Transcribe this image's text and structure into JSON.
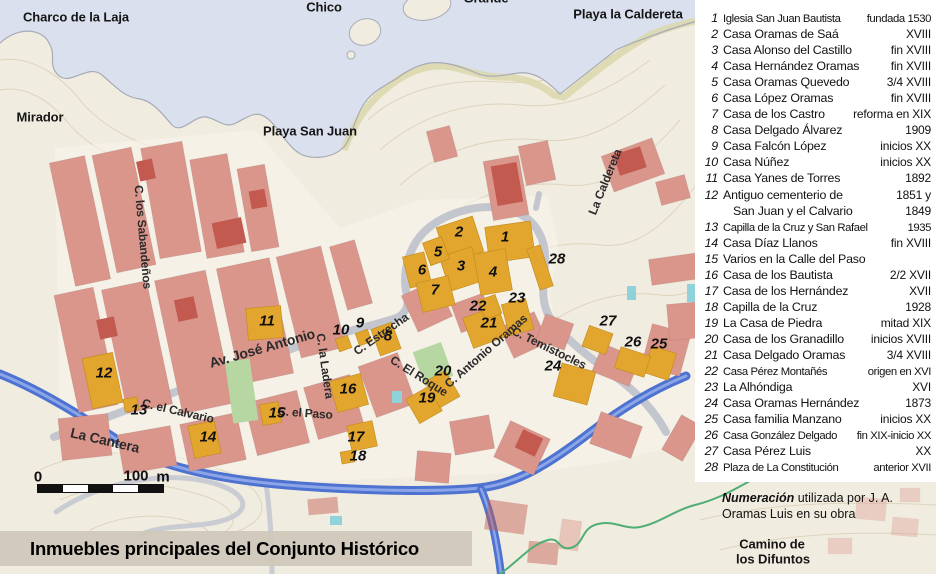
{
  "title": {
    "text": "Inmuebles principales del Conjunto Histórico"
  },
  "colors": {
    "land": "#f1ece0",
    "town": "#f8f5ed",
    "water": "#dbe0ee",
    "coastline": "#a7abb5",
    "beach": "#dbd8ab",
    "contour": "#dcd2b8",
    "roadgray": "#c3c6ce",
    "highway": "#4d72d0",
    "highwaylight": "#8ba5e8",
    "pink": "#db968c",
    "darkred": "#c25a4f",
    "yellow": "#e2a52e",
    "yellowedge": "#c08a1a",
    "park": "#b6d7a2",
    "teal": "#8fd2da",
    "pathgreen": "#4fae74",
    "band": "rgba(208,200,186,0.95)"
  },
  "legend": {
    "items": [
      {
        "num": "1",
        "name": "Iglesia San Juan Bautista",
        "date": "fundada 1530",
        "cls": "tight"
      },
      {
        "num": "2",
        "name": "Casa Oramas de Saá",
        "date": "XVIII"
      },
      {
        "num": "3",
        "name": "Casa Alonso del Castillo",
        "date": "fin XVIII"
      },
      {
        "num": "4",
        "name": "Casa Hernández Oramas",
        "date": "fin XVIII"
      },
      {
        "num": "5",
        "name": "Casa Oramas Quevedo",
        "date": "3/4 XVIII"
      },
      {
        "num": "6",
        "name": "Casa López Oramas",
        "date": "fin XVIII"
      },
      {
        "num": "7",
        "name": "Casa de los Castro",
        "date": "reforma en XIX"
      },
      {
        "num": "8",
        "name": "Casa Delgado Álvarez",
        "date": "1909"
      },
      {
        "num": "9",
        "name": "Casa Falcón López",
        "date": "inicios XX"
      },
      {
        "num": "10",
        "name": "Casa Núñez",
        "date": "inicios XX"
      },
      {
        "num": "11",
        "name": "Casa Yanes de Torres",
        "date": "1892"
      },
      {
        "num": "12",
        "name": "Antiguo cementerio de",
        "date": "1851 y"
      },
      {
        "num": "",
        "name": "San Juan y el Calvario",
        "date": "1849",
        "cls": "cont"
      },
      {
        "num": "13",
        "name": "Capilla de la Cruz y San Rafael",
        "date": "1935",
        "cls": "tight"
      },
      {
        "num": "14",
        "name": "Casa Díaz Llanos",
        "date": "fin XVIII"
      },
      {
        "num": "15",
        "name": "Varios en la Calle del Paso",
        "date": ""
      },
      {
        "num": "16",
        "name": "Casa de los Bautista",
        "date": "2/2 XVII"
      },
      {
        "num": "17",
        "name": "Casa de los Hernández",
        "date": "XVII"
      },
      {
        "num": "18",
        "name": "Capilla de la Cruz",
        "date": "1928"
      },
      {
        "num": "19",
        "name": "La Casa de Piedra",
        "date": "mitad XIX"
      },
      {
        "num": "20",
        "name": "Casa de los Granadillo",
        "date": "inicios XVIII"
      },
      {
        "num": "21",
        "name": "Casa Delgado Oramas",
        "date": "3/4 XVIII"
      },
      {
        "num": "22",
        "name": "Casa Pérez Montañés",
        "date": "origen en XVI",
        "cls": "tight"
      },
      {
        "num": "23",
        "name": "La Alhóndiga",
        "date": "XVI"
      },
      {
        "num": "24",
        "name": "Casa Oramas Hernández",
        "date": "1873"
      },
      {
        "num": "25",
        "name": "Casa familia Manzano",
        "date": "inicios XX"
      },
      {
        "num": "26",
        "name": "Casa González Delgado",
        "date": "fin XIX-inicio XX",
        "cls": "tight"
      },
      {
        "num": "27",
        "name": "Casa Pérez Luis",
        "date": "XX"
      },
      {
        "num": "28",
        "name": "Plaza de La Constitución",
        "date": "anterior XVII",
        "cls": "tight"
      }
    ],
    "note_bold": "Numeración",
    "note_rest": " utilizada por J. A.",
    "note_line2": "Oramas Luis en su obra"
  },
  "scalebar": {
    "zero": "0",
    "hundred": "100",
    "unit": "m"
  },
  "map": {
    "places": [
      {
        "text": "Charco de la Laja",
        "x": 76,
        "y": 17
      },
      {
        "text": "Chico",
        "x": 324,
        "y": 7
      },
      {
        "text": "Grande",
        "x": 486,
        "y": -2
      },
      {
        "text": "Playa la Caldereta",
        "x": 628,
        "y": 14
      },
      {
        "text": "Mirador",
        "x": 40,
        "y": 117
      },
      {
        "text": "Playa San Juan",
        "x": 310,
        "y": 131
      },
      {
        "text": "Camino de",
        "x": 772,
        "y": 544
      },
      {
        "text": "los Difuntos",
        "x": 773,
        "y": 559
      }
    ],
    "streets": [
      {
        "text": "C. los Sabandeños",
        "x": 143,
        "y": 237,
        "rot": 85
      },
      {
        "text": "Av. José Antonio",
        "x": 262,
        "y": 348,
        "rot": -16,
        "sz": 14
      },
      {
        "text": "C. la Ladera",
        "x": 325,
        "y": 366,
        "rot": 82
      },
      {
        "text": "C. Estrecha",
        "x": 381,
        "y": 334,
        "rot": -35
      },
      {
        "text": "C. El Roque",
        "x": 419,
        "y": 376,
        "rot": 32
      },
      {
        "text": "C. Antonio Oramas",
        "x": 486,
        "y": 351,
        "rot": -41
      },
      {
        "text": "C. Temístocles",
        "x": 549,
        "y": 348,
        "rot": 26
      },
      {
        "text": "C. el Calvario",
        "x": 178,
        "y": 411,
        "rot": 13
      },
      {
        "text": "La Cantera",
        "x": 105,
        "y": 440,
        "rot": 13,
        "sz": 14
      },
      {
        "text": "C. el Paso",
        "x": 305,
        "y": 413,
        "rot": 4
      },
      {
        "text": "La Caldereta",
        "x": 605,
        "y": 182,
        "rot": -68
      }
    ],
    "markers": [
      {
        "n": "1",
        "x": 505,
        "y": 237
      },
      {
        "n": "2",
        "x": 459,
        "y": 232
      },
      {
        "n": "3",
        "x": 461,
        "y": 266
      },
      {
        "n": "4",
        "x": 493,
        "y": 272
      },
      {
        "n": "5",
        "x": 438,
        "y": 252
      },
      {
        "n": "6",
        "x": 422,
        "y": 270
      },
      {
        "n": "7",
        "x": 435,
        "y": 290
      },
      {
        "n": "8",
        "x": 388,
        "y": 336
      },
      {
        "n": "9",
        "x": 360,
        "y": 323
      },
      {
        "n": "10",
        "x": 341,
        "y": 330
      },
      {
        "n": "11",
        "x": 267,
        "y": 321
      },
      {
        "n": "12",
        "x": 104,
        "y": 373
      },
      {
        "n": "13",
        "x": 139,
        "y": 410
      },
      {
        "n": "14",
        "x": 208,
        "y": 437
      },
      {
        "n": "15",
        "x": 277,
        "y": 413
      },
      {
        "n": "16",
        "x": 348,
        "y": 389
      },
      {
        "n": "17",
        "x": 356,
        "y": 437
      },
      {
        "n": "18",
        "x": 358,
        "y": 456
      },
      {
        "n": "19",
        "x": 427,
        "y": 398
      },
      {
        "n": "20",
        "x": 443,
        "y": 371
      },
      {
        "n": "21",
        "x": 489,
        "y": 323
      },
      {
        "n": "22",
        "x": 478,
        "y": 306
      },
      {
        "n": "23",
        "x": 517,
        "y": 298
      },
      {
        "n": "24",
        "x": 553,
        "y": 366
      },
      {
        "n": "25",
        "x": 659,
        "y": 344
      },
      {
        "n": "26",
        "x": 633,
        "y": 342
      },
      {
        "n": "27",
        "x": 608,
        "y": 321
      },
      {
        "n": "28",
        "x": 557,
        "y": 259
      }
    ]
  }
}
